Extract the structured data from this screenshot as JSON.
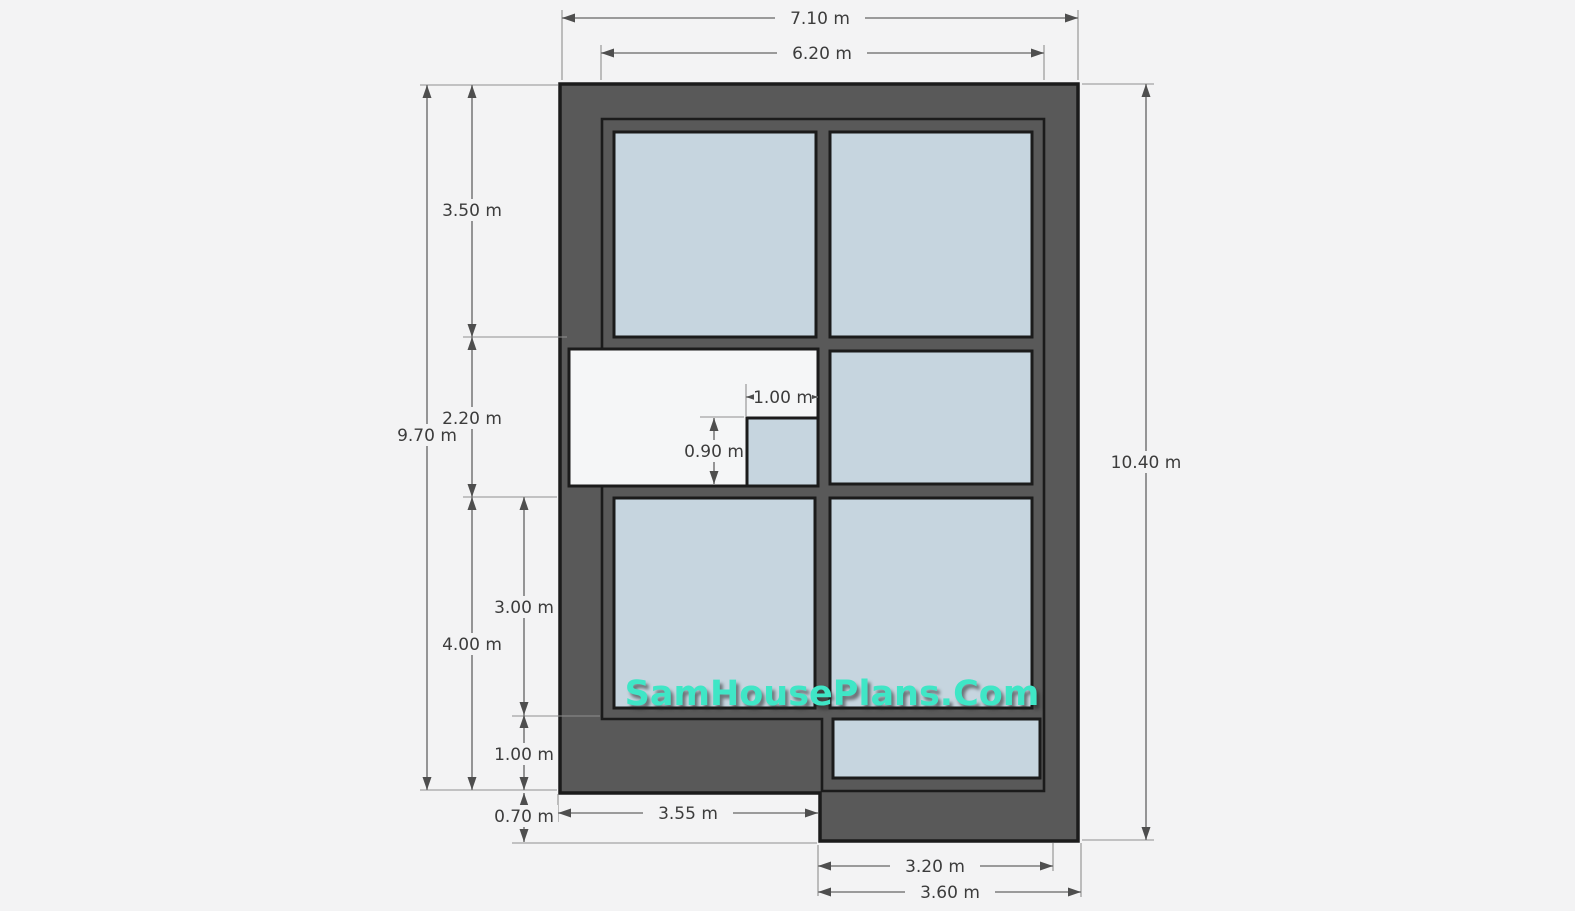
{
  "watermark": {
    "text": "SamHousePlans.Com"
  },
  "plan": {
    "unit": "m",
    "colors": {
      "wall": "#595959",
      "outline": "#1b1b1b",
      "room": "#c6d5df",
      "open_area": "#f5f6f7",
      "background": "#f3f3f4",
      "dim_line": "#7d7d7d",
      "ext_line": "#8f8f8f",
      "arrow": "#4e4e4e",
      "dim_text": "#3c3c3c",
      "watermark": "#3fe6c6"
    },
    "dimensions": {
      "overall_width": "7.10 m",
      "inner_width": "6.20 m",
      "upper_height": "3.50 m",
      "porch_height": "2.20 m",
      "left_height": "9.70 m",
      "lower_inner_height": "3.00 m",
      "lower_height": "4.00 m",
      "lower_wall_band": "1.00 m",
      "bottom_step": "0.70 m",
      "overall_height": "10.40 m",
      "niche_width": "1.00 m",
      "niche_height": "0.90 m",
      "bottom_left_width": "3.55 m",
      "extension_inner_width": "3.20 m",
      "extension_width": "3.60 m"
    }
  }
}
